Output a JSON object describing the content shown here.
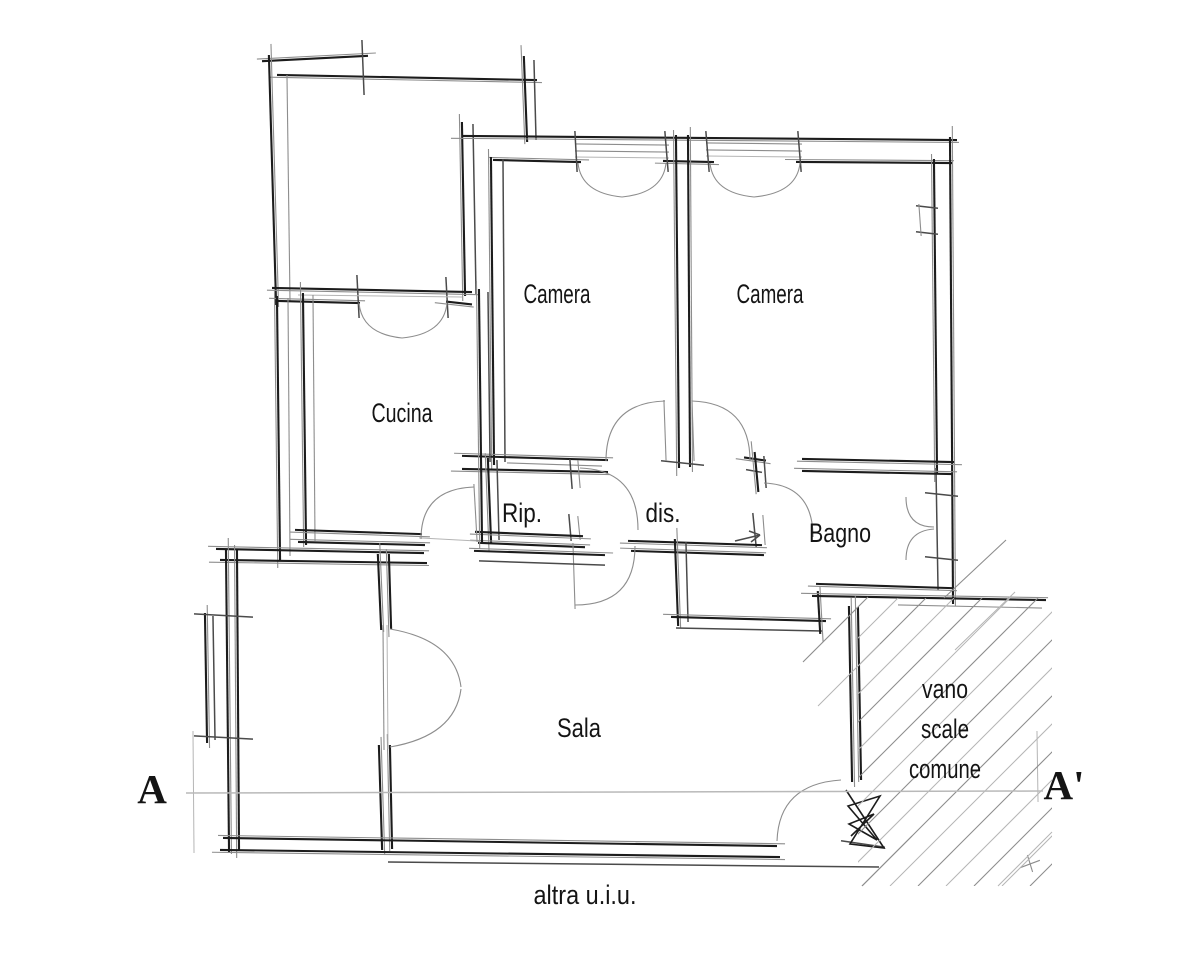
{
  "floor_plan": {
    "rooms": {
      "camera_left": {
        "label": "Camera"
      },
      "camera_right": {
        "label": "Camera"
      },
      "cucina": {
        "label": "Cucina"
      },
      "ripostiglio": {
        "label": "Rip."
      },
      "disimpegno": {
        "label": "dis."
      },
      "bagno": {
        "label": "Bagno"
      },
      "sala": {
        "label": "Sala"
      }
    },
    "stairwell": {
      "label_lines": [
        "vano",
        "scale",
        "comune"
      ]
    },
    "section": {
      "start_marker": "A",
      "end_marker": "A'"
    },
    "footer_note": "altra u.i.u.",
    "colors": {
      "ink": "#1c1c1c",
      "mid": "#4a4a4a",
      "sketch": "#8d8d8d",
      "faint": "#b5b5b5",
      "section_line": "#b9b9b9",
      "background": "#ffffff",
      "text": "#141414"
    }
  }
}
